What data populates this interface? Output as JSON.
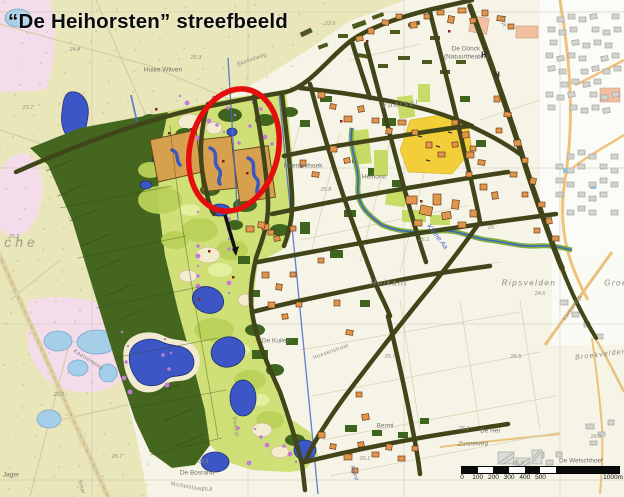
{
  "title": "“De Heihorsten” streefbeeld",
  "palette": {
    "annotation_red": "#e60d0d",
    "forest_green": "#44661f",
    "golf_green": "#cfe077",
    "heath_yellow": "#e9e6ba",
    "pink_area": "#f4dcea",
    "water_dark": "#3c57c5",
    "water_light": "#a5cfe8",
    "field_yellow": "#f2ce38",
    "road_olive": "#41461a",
    "farm_orange": "#e0974c",
    "heather_purple": "#c47ad6",
    "sand_tan": "#d7a04e",
    "urban_gray": "#d4d4cf",
    "background": "#f6f4e7"
  },
  "scalebar": {
    "ticks": [
      "0",
      "100",
      "200",
      "300",
      "400",
      "500"
    ],
    "end_label": "1000m"
  },
  "map_labels": [
    {
      "t": "Huize Witven",
      "x": 163,
      "y": 70,
      "rot": 0,
      "cls": "place"
    },
    {
      "t": "De Dönck",
      "x": 466,
      "y": 49,
      "rot": 0,
      "cls": "place"
    },
    {
      "t": "(Natuurtheater)",
      "x": 466,
      "y": 57,
      "rot": 0,
      "cls": "place"
    },
    {
      "t": "Ekehofweg",
      "x": 252,
      "y": 60,
      "rot": -20,
      "cls": "road"
    },
    {
      "t": "Vaarsel",
      "x": 400,
      "y": 104,
      "rot": -4,
      "cls": "area"
    },
    {
      "t": "Heerdsehoek",
      "x": 303,
      "y": 166,
      "rot": 0,
      "cls": "place"
    },
    {
      "t": "Heihorst",
      "x": 374,
      "y": 177,
      "rot": 0,
      "cls": "place"
    },
    {
      "t": "Heikant",
      "x": 389,
      "y": 283,
      "rot": 0,
      "cls": "area"
    },
    {
      "t": "Ripsvelden",
      "x": 529,
      "y": 283,
      "rot": 0,
      "cls": "area"
    },
    {
      "t": "Groe",
      "x": 616,
      "y": 283,
      "rot": 0,
      "cls": "area"
    },
    {
      "t": "Kleine Aa",
      "x": 437,
      "y": 237,
      "rot": 52,
      "cls": "water"
    },
    {
      "t": "sche",
      "x": 16,
      "y": 242,
      "rot": 0,
      "cls": "bigarea"
    },
    {
      "t": "De Kuilen",
      "x": 276,
      "y": 341,
      "rot": 0,
      "cls": "place"
    },
    {
      "t": "De Bosrand",
      "x": 197,
      "y": 473,
      "rot": 0,
      "cls": "place"
    },
    {
      "t": "Michelslaan",
      "x": 187,
      "y": 487,
      "rot": 10,
      "cls": "road"
    },
    {
      "t": "Kaelvenweg",
      "x": 88,
      "y": 360,
      "rot": 32,
      "cls": "road"
    },
    {
      "t": "Peelrijt",
      "x": 235,
      "y": 427,
      "rot": 80,
      "cls": "road"
    },
    {
      "t": "Peelrijt",
      "x": 354,
      "y": 473,
      "rot": 72,
      "cls": "waterSmall"
    },
    {
      "t": "Jager",
      "x": 11,
      "y": 475,
      "rot": 0,
      "cls": "place"
    },
    {
      "t": "Smal",
      "x": 81,
      "y": 487,
      "rot": 75,
      "cls": "road"
    },
    {
      "t": "Hoevenstraat",
      "x": 331,
      "y": 352,
      "rot": -20,
      "cls": "road"
    },
    {
      "t": "Bermi",
      "x": 385,
      "y": 426,
      "rot": 0,
      "cls": "place"
    },
    {
      "t": "Zonneweg",
      "x": 473,
      "y": 444,
      "rot": -2,
      "cls": "placeit"
    },
    {
      "t": "De Hei",
      "x": 490,
      "y": 431,
      "rot": 0,
      "cls": "place"
    },
    {
      "t": "De Welschhoef",
      "x": 581,
      "y": 461,
      "rot": 0,
      "cls": "place"
    },
    {
      "t": "Broekvelden",
      "x": 601,
      "y": 355,
      "rot": -7,
      "cls": "area2"
    },
    {
      "t": "Kerkendijk",
      "x": 573,
      "y": 308,
      "rot": -55,
      "cls": "road"
    },
    {
      "t": "Dijk",
      "x": 503,
      "y": 22,
      "rot": 75,
      "cls": "road"
    },
    {
      "t": "H",
      "x": 484,
      "y": 55,
      "rot": 0,
      "cls": "symbol"
    },
    {
      "t": "H",
      "x": 497,
      "y": 75,
      "rot": 0,
      "cls": "symbol"
    }
  ],
  "elevations": [
    {
      "t": "24.8",
      "x": 75,
      "y": 50
    },
    {
      "t": "25.3",
      "x": 196,
      "y": 58
    },
    {
      "t": "23.9",
      "x": 330,
      "y": 24
    },
    {
      "t": "23.7",
      "x": 28,
      "y": 108
    },
    {
      "t": "25.2",
      "x": 14,
      "y": 237
    },
    {
      "t": "25.8",
      "x": 326,
      "y": 190
    },
    {
      "t": "26.1",
      "x": 424,
      "y": 240
    },
    {
      "t": "25",
      "x": 491,
      "y": 228
    },
    {
      "t": "24.6",
      "x": 540,
      "y": 294
    },
    {
      "t": "26.5",
      "x": 516,
      "y": 357
    },
    {
      "t": "25.7",
      "x": 390,
      "y": 357
    },
    {
      "t": "26.2",
      "x": 59,
      "y": 395
    },
    {
      "t": "26.7",
      "x": 117,
      "y": 457
    },
    {
      "t": "26.3",
      "x": 203,
      "y": 462
    },
    {
      "t": "25.8",
      "x": 207,
      "y": 490
    },
    {
      "t": "26.1",
      "x": 365,
      "y": 459
    },
    {
      "t": "26.1",
      "x": 464,
      "y": 429
    },
    {
      "t": "26.7",
      "x": 518,
      "y": 464
    },
    {
      "t": "26.6",
      "x": 596,
      "y": 437
    }
  ]
}
